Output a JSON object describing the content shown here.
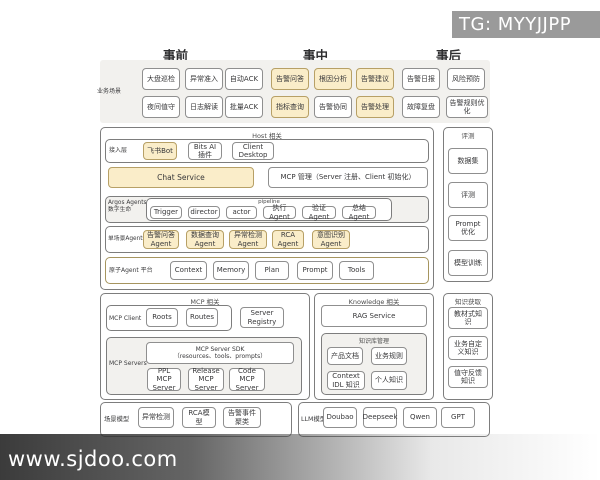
{
  "watermarks": {
    "telegram": "TG: MYYJJPP",
    "site": "www.sjdoo.com"
  },
  "phases": {
    "pre": "事前",
    "mid": "事中",
    "post": "事后"
  },
  "scenarios": {
    "label": "业务场景",
    "row1": [
      "大盘巡检",
      "异常准入",
      "自动ACK",
      "告警问答",
      "根因分析",
      "告警建议",
      "告警日报",
      "风险预防"
    ],
    "row2": [
      "夜间值守",
      "日志解读",
      "批量ACK",
      "指标查询",
      "告警协同",
      "告警处理",
      "故障复盘",
      "告警规则优化"
    ]
  },
  "host": {
    "title": "Host 相关",
    "access_label": "接入层",
    "access_items": [
      "飞书Bot",
      "Bits AI 插件",
      "Client Desktop"
    ],
    "chat_service": "Chat Service",
    "mcp_manage": "MCP 管理（Server 注册、Client 初始化）",
    "argos_label_1": "Argos Agents",
    "argos_label_2": "数字生命",
    "pipeline_title": "pipeline",
    "pipeline_items": [
      "Trigger",
      "director",
      "actor",
      "执行Agent",
      "验证Agent",
      "总结Agent"
    ],
    "single_label": "单场景Agents",
    "single_items": [
      "告警问答Agent",
      "数据查询Agent",
      "异常检测Agent",
      "RCA Agent",
      "意图识别Agent"
    ],
    "atomic_label": "原子Agent 平台",
    "atomic_items": [
      "Context",
      "Memory",
      "Plan",
      "Prompt",
      "Tools"
    ]
  },
  "mcp": {
    "title": "MCP 相关",
    "client_label": "MCP Client",
    "client_items": [
      "Roots",
      "Routes"
    ],
    "server_registry": "Server Registry",
    "servers_label": "MCP Servers",
    "sdk_line1": "MCP Server SDK",
    "sdk_line2": "（resources、tools、prompts）",
    "servers": [
      "PPL MCP Server",
      "Release MCP Server",
      "Code MCP Server"
    ]
  },
  "knowledge": {
    "title": "Knowledge 相关",
    "rag": "RAG Service",
    "kb_title": "知识库管理",
    "kb_items": [
      "产品文档",
      "业务规则",
      "Context IDL 知识",
      "个人知识"
    ]
  },
  "evaluation": {
    "title": "评测",
    "items": [
      "数据集",
      "评测",
      "Prompt 优化",
      "模型训练"
    ]
  },
  "acquisition": {
    "title": "知识获取",
    "items": [
      "教材式知识",
      "业务自定义知识",
      "值守反馈知识"
    ]
  },
  "scene_models": {
    "label": "场景模型",
    "items": [
      "异常检测",
      "RCA模型",
      "告警事件聚类"
    ]
  },
  "llm_models": {
    "label": "LLM模型",
    "items": [
      "Doubao",
      "Deepseek",
      "Qwen",
      "GPT"
    ]
  }
}
